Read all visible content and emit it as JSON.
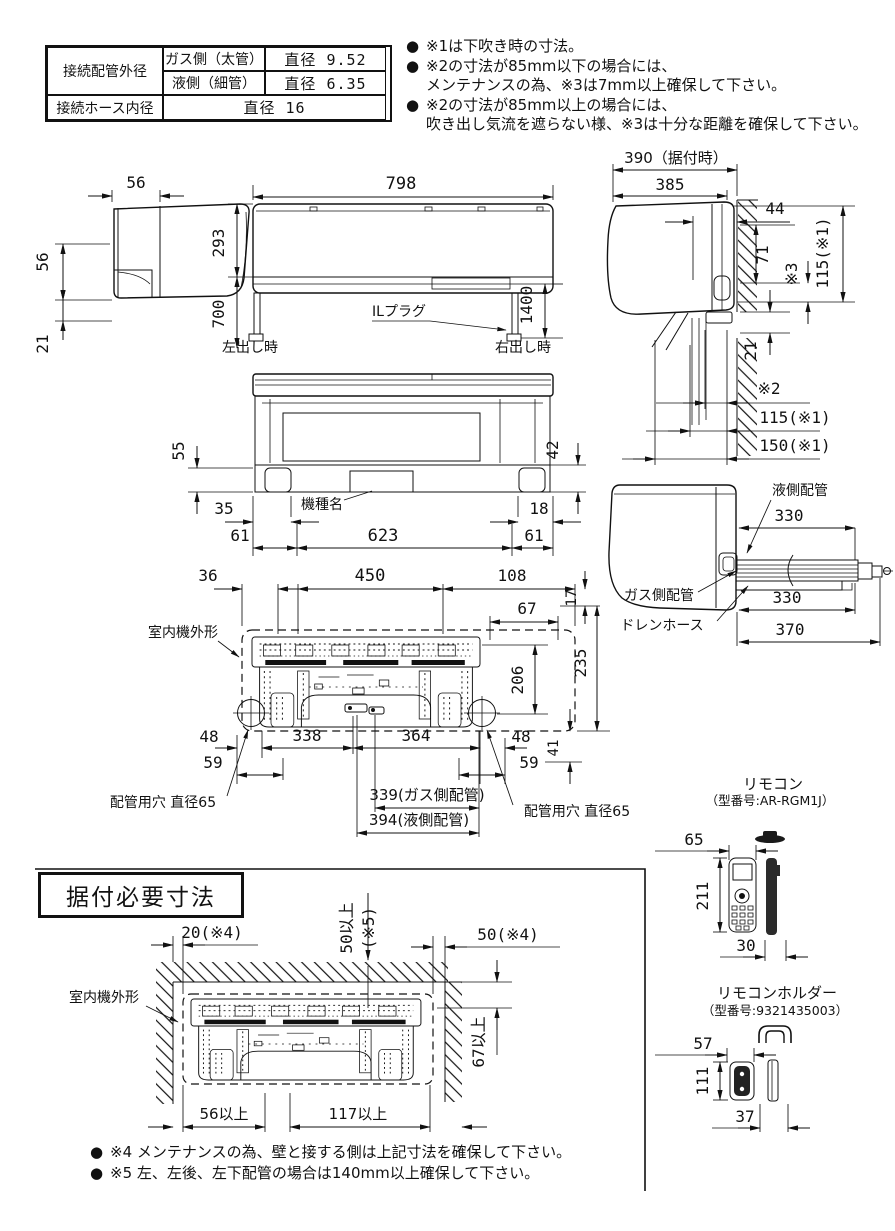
{
  "spec_table": {
    "pipe_outer_label": "接続配管外径",
    "gas_label": "ガス側（太管）",
    "gas_value": "直径 9.52",
    "liquid_label": "液側（細管）",
    "liquid_value": "直径 6.35",
    "hose_label": "接続ホース内径",
    "hose_value": "直径 16"
  },
  "notes_top": [
    {
      "bullet": "●",
      "text": "※1は下吹き時の寸法。"
    },
    {
      "bullet": "●",
      "text": "※2の寸法が85mm以下の場合には、"
    },
    {
      "bullet": "",
      "text": "メンテナンスの為、※3は7mm以上確保して下さい。"
    },
    {
      "bullet": "●",
      "text": "※2の寸法が85mm以上の場合には、"
    },
    {
      "bullet": "",
      "text": "吹き出し気流を遮らない様、※3は十分な距離を確保して下さい。"
    }
  ],
  "side_view": {
    "d56_top": "56",
    "d56_left": "56",
    "d21": "21"
  },
  "front_view": {
    "d798": "798",
    "d293": "293",
    "d700": "700",
    "d1400": "1400",
    "left_out": "左出し時",
    "right_out": "右出し時",
    "il_plug": "ILプラグ"
  },
  "install_side": {
    "d390": "390（据付時）",
    "d385": "385",
    "d44": "44",
    "d71": "71",
    "s3": "※3",
    "d115_top": "115(※1)",
    "d21": "21",
    "s2": "※2",
    "d115": "115(※1)",
    "d150": "150(※1)"
  },
  "bottom_view": {
    "d55": "55",
    "d42": "42",
    "d35": "35",
    "d18": "18",
    "d61_left": "61",
    "d623": "623",
    "d61_right": "61",
    "model_name": "機種名"
  },
  "pipe_view": {
    "liquid": "液側配管",
    "gas": "ガス側配管",
    "drain": "ドレンホース",
    "d330_liquid": "330",
    "d330_gas": "330",
    "d370": "370"
  },
  "rear_view": {
    "outline": "室内機外形",
    "d36": "36",
    "d450": "450",
    "d108": "108",
    "d67": "67",
    "d17": "17",
    "d235": "235",
    "d206": "206",
    "d48_left": "48",
    "d338": "338",
    "d364": "364",
    "d48_right": "48",
    "d41": "41",
    "d59_left": "59",
    "d59_right": "59",
    "d339": "339(ガス側配管)",
    "d394": "394(液側配管)",
    "hole_left": "配管用穴 直径65",
    "hole_right": "配管用穴 直径65"
  },
  "remote": {
    "title": "リモコン",
    "model": "（型番号:AR-RGM1J）",
    "d65": "65",
    "d211": "211",
    "d30": "30"
  },
  "holder": {
    "title": "リモコンホルダー",
    "model": "（型番号:9321435003）",
    "d57": "57",
    "d111": "111",
    "d37": "37"
  },
  "install_req": {
    "title": "据付必要寸法",
    "outline": "室内機外形",
    "d20": "20(※4)",
    "d50v_line1": "50以上",
    "d50v_line2": "(※5)",
    "d50": "50(※4)",
    "d67": "67以上",
    "d56": "56以上",
    "d117": "117以上"
  },
  "notes_bottom": [
    {
      "bullet": "●",
      "text": "※4 メンテナンスの為、壁と接する側は上記寸法を確保して下さい。"
    },
    {
      "bullet": "●",
      "text": "※5 左、左後、左下配管の場合は140mm以上確保して下さい。"
    }
  ]
}
